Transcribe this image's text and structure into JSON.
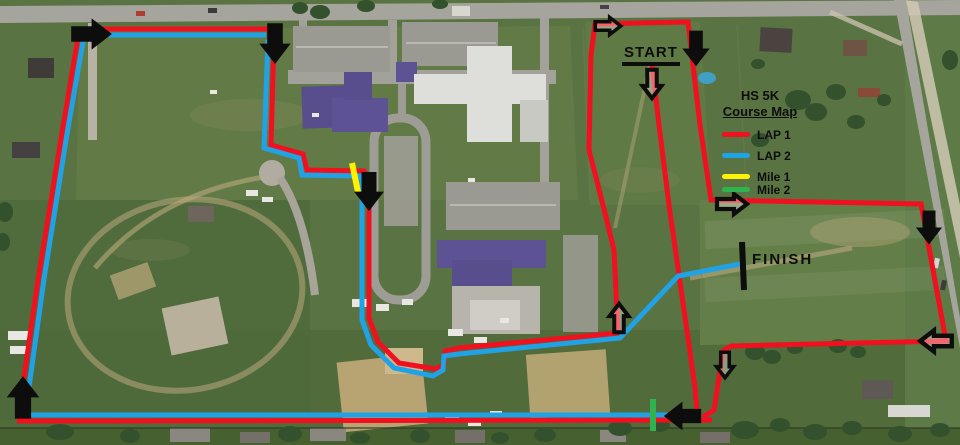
{
  "map": {
    "width": 960,
    "height": 445
  },
  "labels": {
    "start": "START",
    "finish": "FINISH"
  },
  "legend": {
    "title_line1": "HS 5K",
    "title_line2": "Course Map",
    "items": [
      {
        "label": "LAP 1",
        "color": "#f1101f",
        "group": "lap"
      },
      {
        "label": "LAP 2",
        "color": "#21a2e4",
        "group": "lap"
      },
      {
        "label": "Mile 1",
        "color": "#fdf300",
        "group": "mile"
      },
      {
        "label": "Mile 2",
        "color": "#2fb34f",
        "group": "mile"
      }
    ]
  },
  "course": {
    "colors": {
      "lap1": "#f1101f",
      "lap2": "#21a2e4",
      "mile1": "#fdf300",
      "mile2": "#2fb34f",
      "marks": "#0d0d0d"
    },
    "lines": [
      {
        "name": "lap1-top-northwest",
        "color": "#f1101f",
        "width": 5,
        "points": [
          [
            78,
            29
          ],
          [
            268,
            29
          ]
        ]
      },
      {
        "name": "lap1-west-loop",
        "color": "#f1101f",
        "width": 5,
        "points": [
          [
            274,
            38
          ],
          [
            271,
            145
          ],
          [
            303,
            154
          ],
          [
            307,
            170
          ],
          [
            364,
            171
          ],
          [
            369,
            177
          ],
          [
            369,
            318
          ],
          [
            378,
            342
          ],
          [
            399,
            363
          ],
          [
            436,
            369
          ],
          [
            444,
            364
          ],
          [
            445,
            351
          ],
          [
            459,
            348
          ],
          [
            619,
            333
          ]
        ]
      },
      {
        "name": "lap1-north-loop",
        "color": "#f1101f",
        "width": 5,
        "points": [
          [
            618,
            334
          ],
          [
            614,
            250
          ],
          [
            604,
            209
          ],
          [
            589,
            150
          ],
          [
            591,
            55
          ],
          [
            595,
            24
          ],
          [
            688,
            22
          ],
          [
            700,
            125
          ],
          [
            711,
            200
          ],
          [
            921,
            204
          ],
          [
            946,
            341
          ],
          [
            731,
            346
          ],
          [
            723,
            351
          ],
          [
            714,
            410
          ],
          [
            703,
            417
          ]
        ]
      },
      {
        "name": "lap1-start-stretch",
        "color": "#f1101f",
        "width": 5,
        "points": [
          [
            652,
            64
          ],
          [
            659,
            125
          ],
          [
            669,
            205
          ],
          [
            679,
            275
          ],
          [
            689,
            345
          ],
          [
            695,
            388
          ],
          [
            697,
            411
          ]
        ]
      },
      {
        "name": "lap1-bottom",
        "color": "#f1101f",
        "width": 5,
        "points": [
          [
            17,
            421
          ],
          [
            712,
            420
          ]
        ]
      },
      {
        "name": "lap1-west-edge",
        "color": "#f1101f",
        "width": 5,
        "points": [
          [
            19,
            412
          ],
          [
            38,
            280
          ],
          [
            62,
            133
          ],
          [
            79,
            31
          ]
        ]
      },
      {
        "name": "lap2-top-northwest",
        "color": "#21a2e4",
        "width": 5,
        "points": [
          [
            82,
            35
          ],
          [
            266,
            35
          ]
        ]
      },
      {
        "name": "lap2-west-loop-to-finish",
        "color": "#21a2e4",
        "width": 5,
        "points": [
          [
            268,
            40
          ],
          [
            264,
            148
          ],
          [
            299,
            158
          ],
          [
            302,
            175
          ],
          [
            361,
            176
          ],
          [
            362,
            182
          ],
          [
            362,
            320
          ],
          [
            371,
            345
          ],
          [
            394,
            368
          ],
          [
            433,
            376
          ],
          [
            443,
            370
          ],
          [
            444,
            356
          ],
          [
            459,
            354
          ],
          [
            620,
            338
          ],
          [
            678,
            276
          ],
          [
            740,
            264
          ]
        ]
      },
      {
        "name": "lap2-bottom",
        "color": "#21a2e4",
        "width": 5,
        "points": [
          [
            23,
            415
          ],
          [
            696,
            415
          ]
        ]
      },
      {
        "name": "lap2-west-edge",
        "color": "#21a2e4",
        "width": 5,
        "points": [
          [
            26,
            409
          ],
          [
            44,
            279
          ],
          [
            67,
            134
          ],
          [
            84,
            36
          ]
        ]
      },
      {
        "name": "mile1-mark",
        "color": "#fdf300",
        "width": 6,
        "points": [
          [
            352,
            163
          ],
          [
            358,
            192
          ]
        ]
      },
      {
        "name": "mile2-mark",
        "color": "#2fb34f",
        "width": 6,
        "points": [
          [
            653,
            399
          ],
          [
            653,
            431
          ]
        ]
      },
      {
        "name": "finish-line",
        "color": "#0d0d0d",
        "width": 6,
        "points": [
          [
            742,
            242
          ],
          [
            744,
            290
          ]
        ]
      }
    ],
    "arrows": [
      {
        "name": "arrow-right-top-west",
        "x": 91,
        "y": 34,
        "angle": 0,
        "style": "solid",
        "scale": 1.2
      },
      {
        "name": "arrow-down-top-west",
        "x": 275,
        "y": 43,
        "angle": 90,
        "style": "solid",
        "scale": 1.2
      },
      {
        "name": "arrow-down-mile1",
        "x": 369,
        "y": 191,
        "angle": 90,
        "style": "solid",
        "scale": 1.15
      },
      {
        "name": "arrow-right-start-corner",
        "x": 608,
        "y": 26,
        "angle": 0,
        "style": "outline",
        "scale": 0.85
      },
      {
        "name": "arrow-down-start-field-east",
        "x": 696,
        "y": 48,
        "angle": 90,
        "style": "solid",
        "scale": 1.05
      },
      {
        "name": "arrow-down-below-start",
        "x": 652,
        "y": 84,
        "angle": 90,
        "style": "outline",
        "scale": 0.95
      },
      {
        "name": "arrow-right-to-east-field",
        "x": 732,
        "y": 204,
        "angle": 0,
        "style": "outline",
        "scale": 1.0
      },
      {
        "name": "arrow-down-east-edge",
        "x": 929,
        "y": 227,
        "angle": 90,
        "style": "solid",
        "scale": 1.0
      },
      {
        "name": "arrow-left-southeast",
        "x": 936,
        "y": 341,
        "angle": 180,
        "style": "outline",
        "scale": 1.05
      },
      {
        "name": "arrow-down-inner-east",
        "x": 725,
        "y": 365,
        "angle": 90,
        "style": "outline",
        "scale": 0.85
      },
      {
        "name": "arrow-up-to-finish-junction",
        "x": 619,
        "y": 318,
        "angle": 270,
        "style": "outline",
        "scale": 0.95
      },
      {
        "name": "arrow-left-bottom",
        "x": 683,
        "y": 416,
        "angle": 180,
        "style": "solid",
        "scale": 1.1
      },
      {
        "name": "arrow-up-bottom-west",
        "x": 23,
        "y": 398,
        "angle": 270,
        "style": "solid",
        "scale": 1.25
      }
    ]
  }
}
